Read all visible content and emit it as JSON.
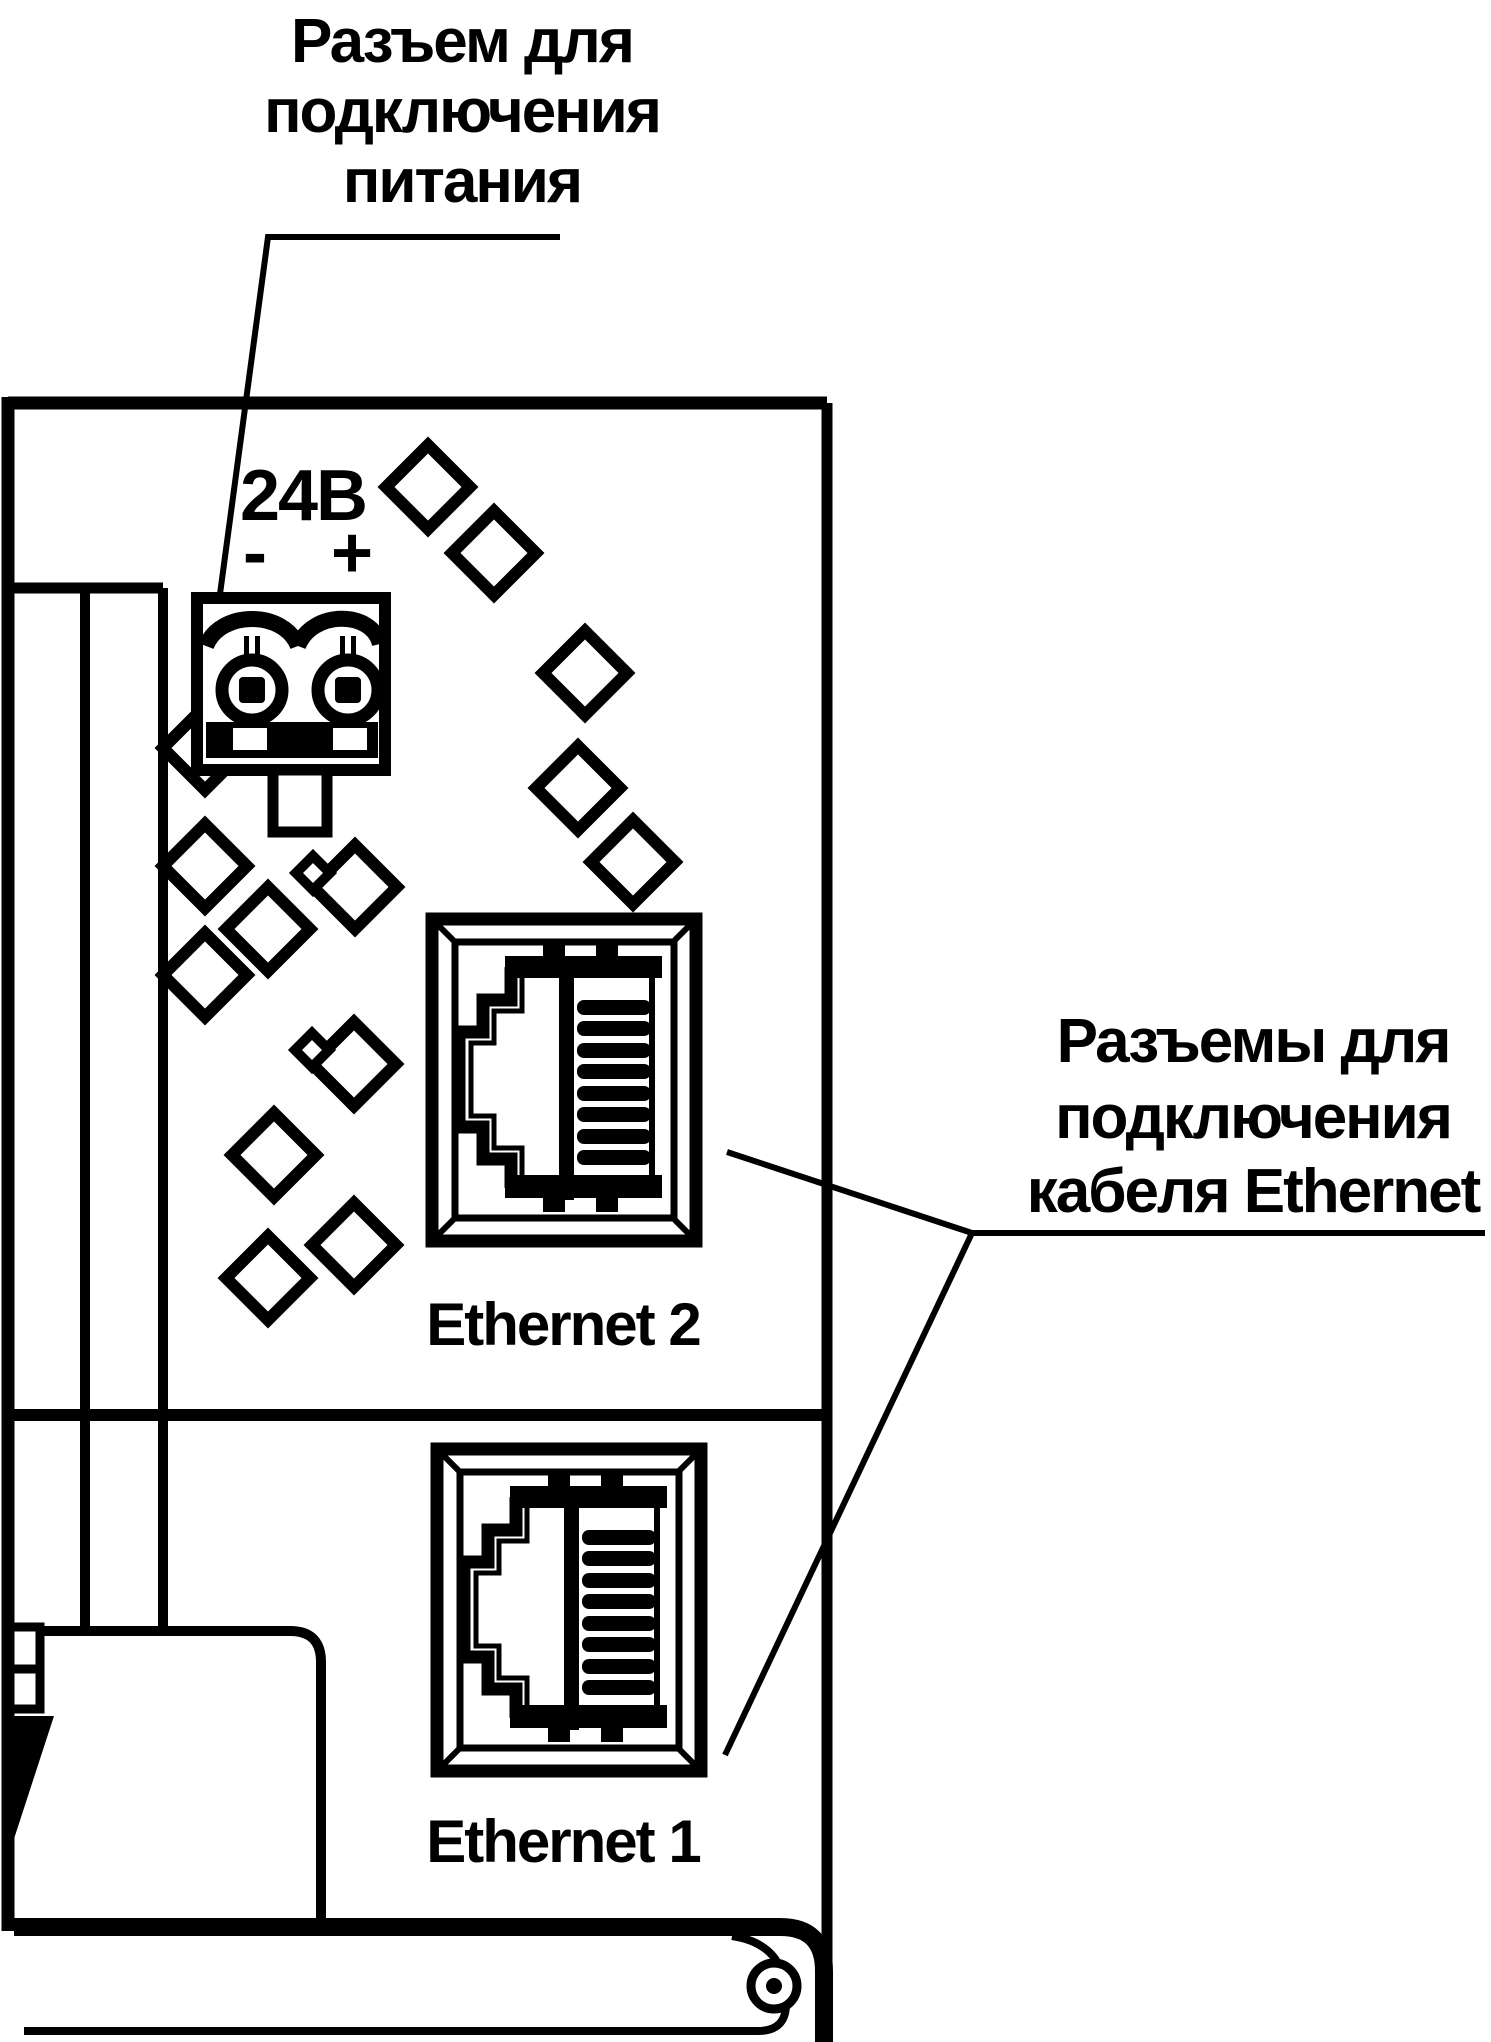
{
  "diagram": {
    "power_label": {
      "line1": "Разъем для",
      "line2": "подключения",
      "line3": "питания"
    },
    "ethernet_label": {
      "line1": "Разъемы для",
      "line2": "подключения",
      "line3": "кабеля Ethernet"
    },
    "power_connector": {
      "voltage": "24В",
      "minus": "-",
      "plus": "+"
    },
    "port_labels": {
      "ethernet2": "Ethernet 2",
      "ethernet1": "Ethernet 1"
    },
    "icons": {
      "power_terminal": "screw-terminal-2pin-icon",
      "rj45": "rj45-port-icon",
      "pattern": "rhombus-pattern-icon",
      "screw": "screw-head-icon"
    },
    "colors": {
      "line": "#000000",
      "background": "#ffffff"
    }
  }
}
